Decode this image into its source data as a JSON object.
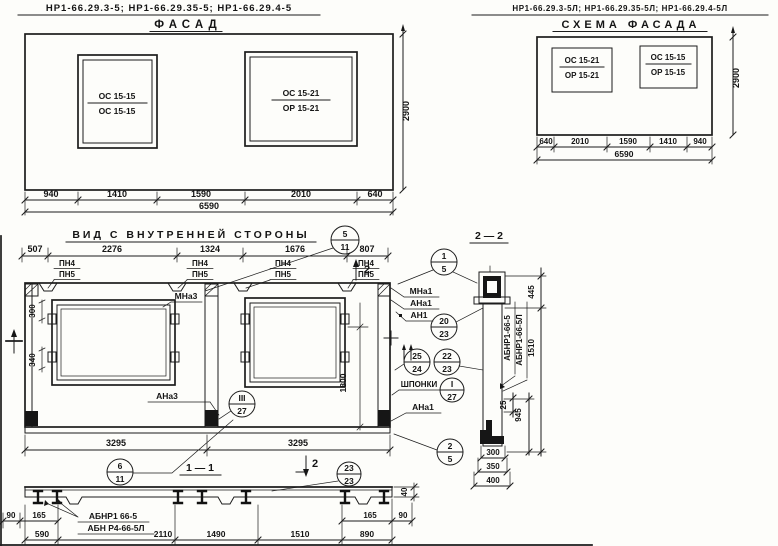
{
  "colors": {
    "paper": "#fdfdfa",
    "ink": "#1c1c1c"
  },
  "headers": {
    "left": {
      "codes": "НР1-66.29.3-5; НР1-66.29.35-5; НР1-66.29.4-5",
      "title": "ФАСАД"
    },
    "right": {
      "codes": "НР1-66.29.3-5Л; НР1-66.29.35-5Л; НР1-66.29.4-5Л",
      "title": "СХЕМА ФАСАДА"
    }
  },
  "facade": {
    "left_window": {
      "top": "ОС 15-15",
      "bottom": "ОС 15-15"
    },
    "right_window": {
      "top": "ОС 15-21",
      "bottom": "ОР 15-21"
    },
    "dims": [
      "940",
      "1410",
      "1590",
      "2010",
      "640"
    ],
    "total": "6590",
    "height": "2900"
  },
  "schema": {
    "left_window": {
      "top": "ОС 15-21",
      "bottom": "ОР 15-21"
    },
    "right_window": {
      "top": "ОС 15-15",
      "bottom": "ОР 15-15"
    },
    "dims": [
      "640",
      "2010",
      "1590",
      "1410",
      "940"
    ],
    "total": "6590",
    "height": "2900"
  },
  "inner": {
    "title": "ВИД С ВНУТРЕННЕЙ СТОРОНЫ",
    "top_dims": [
      "507",
      "2276",
      "1324",
      "1676",
      "807"
    ],
    "pn4": "ПН4",
    "pn5": "ПН5",
    "mna3": "МНа3",
    "ana3": "АНа3",
    "mna1": "МНа1",
    "ana1": "АНа1",
    "an1": "АН1",
    "ana1_lower": "АНа1",
    "shponki": "ШПОНКИ",
    "dim_300": "300",
    "dim_340": "340",
    "dim_1800": "1800",
    "bottom_dims": [
      "3295",
      "3295"
    ],
    "marker_top": "2",
    "marker_bottom": "2",
    "section_label": "1 — 1"
  },
  "callouts": {
    "c5_11": {
      "top": "5",
      "bottom": "11"
    },
    "c1_5": {
      "top": "1",
      "bottom": "5"
    },
    "c20_23": {
      "top": "20",
      "bottom": "23"
    },
    "c25_24": {
      "top": "25",
      "bottom": "24"
    },
    "c22_23": {
      "top": "22",
      "bottom": "23"
    },
    "cI_27": {
      "top": "I",
      "bottom": "27"
    },
    "cIII_27": {
      "top": "III",
      "bottom": "27"
    },
    "c2_5": {
      "top": "2",
      "bottom": "5"
    },
    "c6_11": {
      "top": "6",
      "bottom": "11"
    },
    "c23_23": {
      "top": "23",
      "bottom": "23"
    }
  },
  "section1": {
    "part_top": "АБНР1 66-5",
    "part_bottom": "АБН Р4-66-5Л",
    "dims": [
      "590",
      "2110",
      "1490",
      "1510",
      "890"
    ],
    "left_small": [
      "90",
      "165"
    ],
    "right_small": [
      "165",
      "90"
    ],
    "dim_40": "40"
  },
  "section2": {
    "label": "2 — 2",
    "part1": "АБНР1-66-5",
    "part2": "АБНР1-66-5Л",
    "dim_445": "445",
    "dim_1510": "1510",
    "dim_945": "945",
    "dim_25": "25",
    "bottom_dims": [
      "300",
      "350",
      "400"
    ]
  }
}
